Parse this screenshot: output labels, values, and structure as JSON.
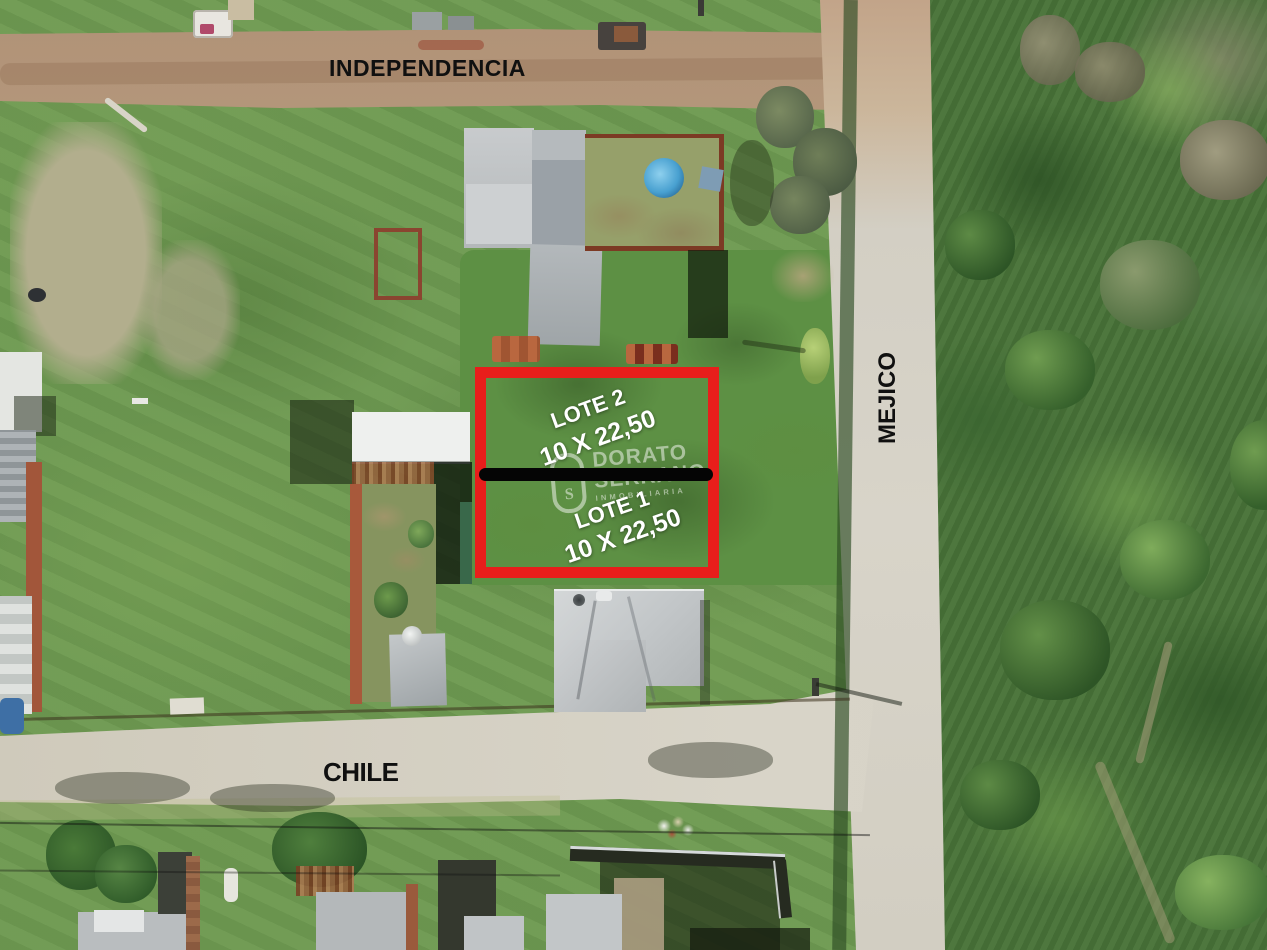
{
  "streets": {
    "top": "INDEPENDENCIA",
    "right": "MEJICO",
    "bottom": "CHILE"
  },
  "lots": [
    {
      "name": "LOTE 2",
      "dimensions": "10 X 22,50"
    },
    {
      "name": "LOTE 1",
      "dimensions": "10 X 22,50"
    }
  ],
  "watermark": {
    "line1": "DORATO",
    "line2": "SERRANO",
    "line3": "INMOBILIARIA"
  },
  "colors": {
    "highlight_red": "#e81e1b",
    "divider_black": "#050505",
    "lot_label_white": "#ffffff",
    "street_label_black": "#101010"
  }
}
